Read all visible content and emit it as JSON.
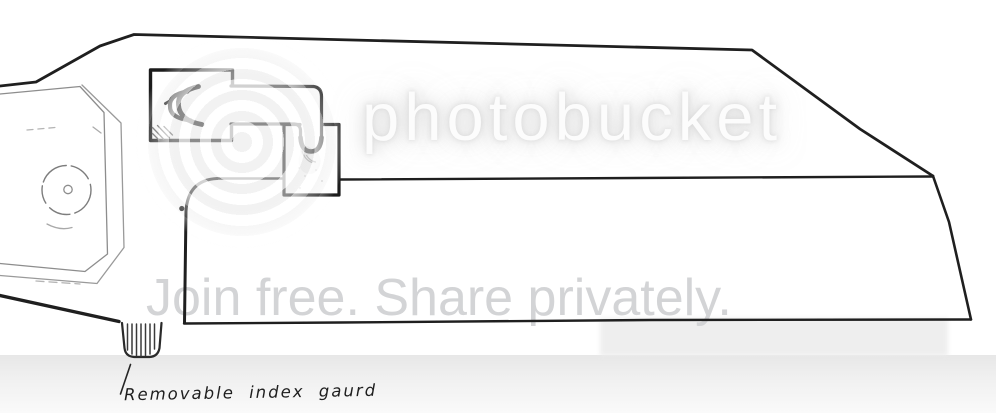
{
  "watermark": {
    "logo_text": "photobucket",
    "tagline": "Join free. Share privately.",
    "logo_text_color": "#fcfcfc",
    "tagline_color": "#d3d4d6"
  },
  "annotation": {
    "text": "Removable index gaurd"
  },
  "colors": {
    "background": "#ffffff",
    "ink": "#1f1f1f",
    "sketch_light": "#8d8d8d",
    "band_gray": "#e9e9e9"
  }
}
